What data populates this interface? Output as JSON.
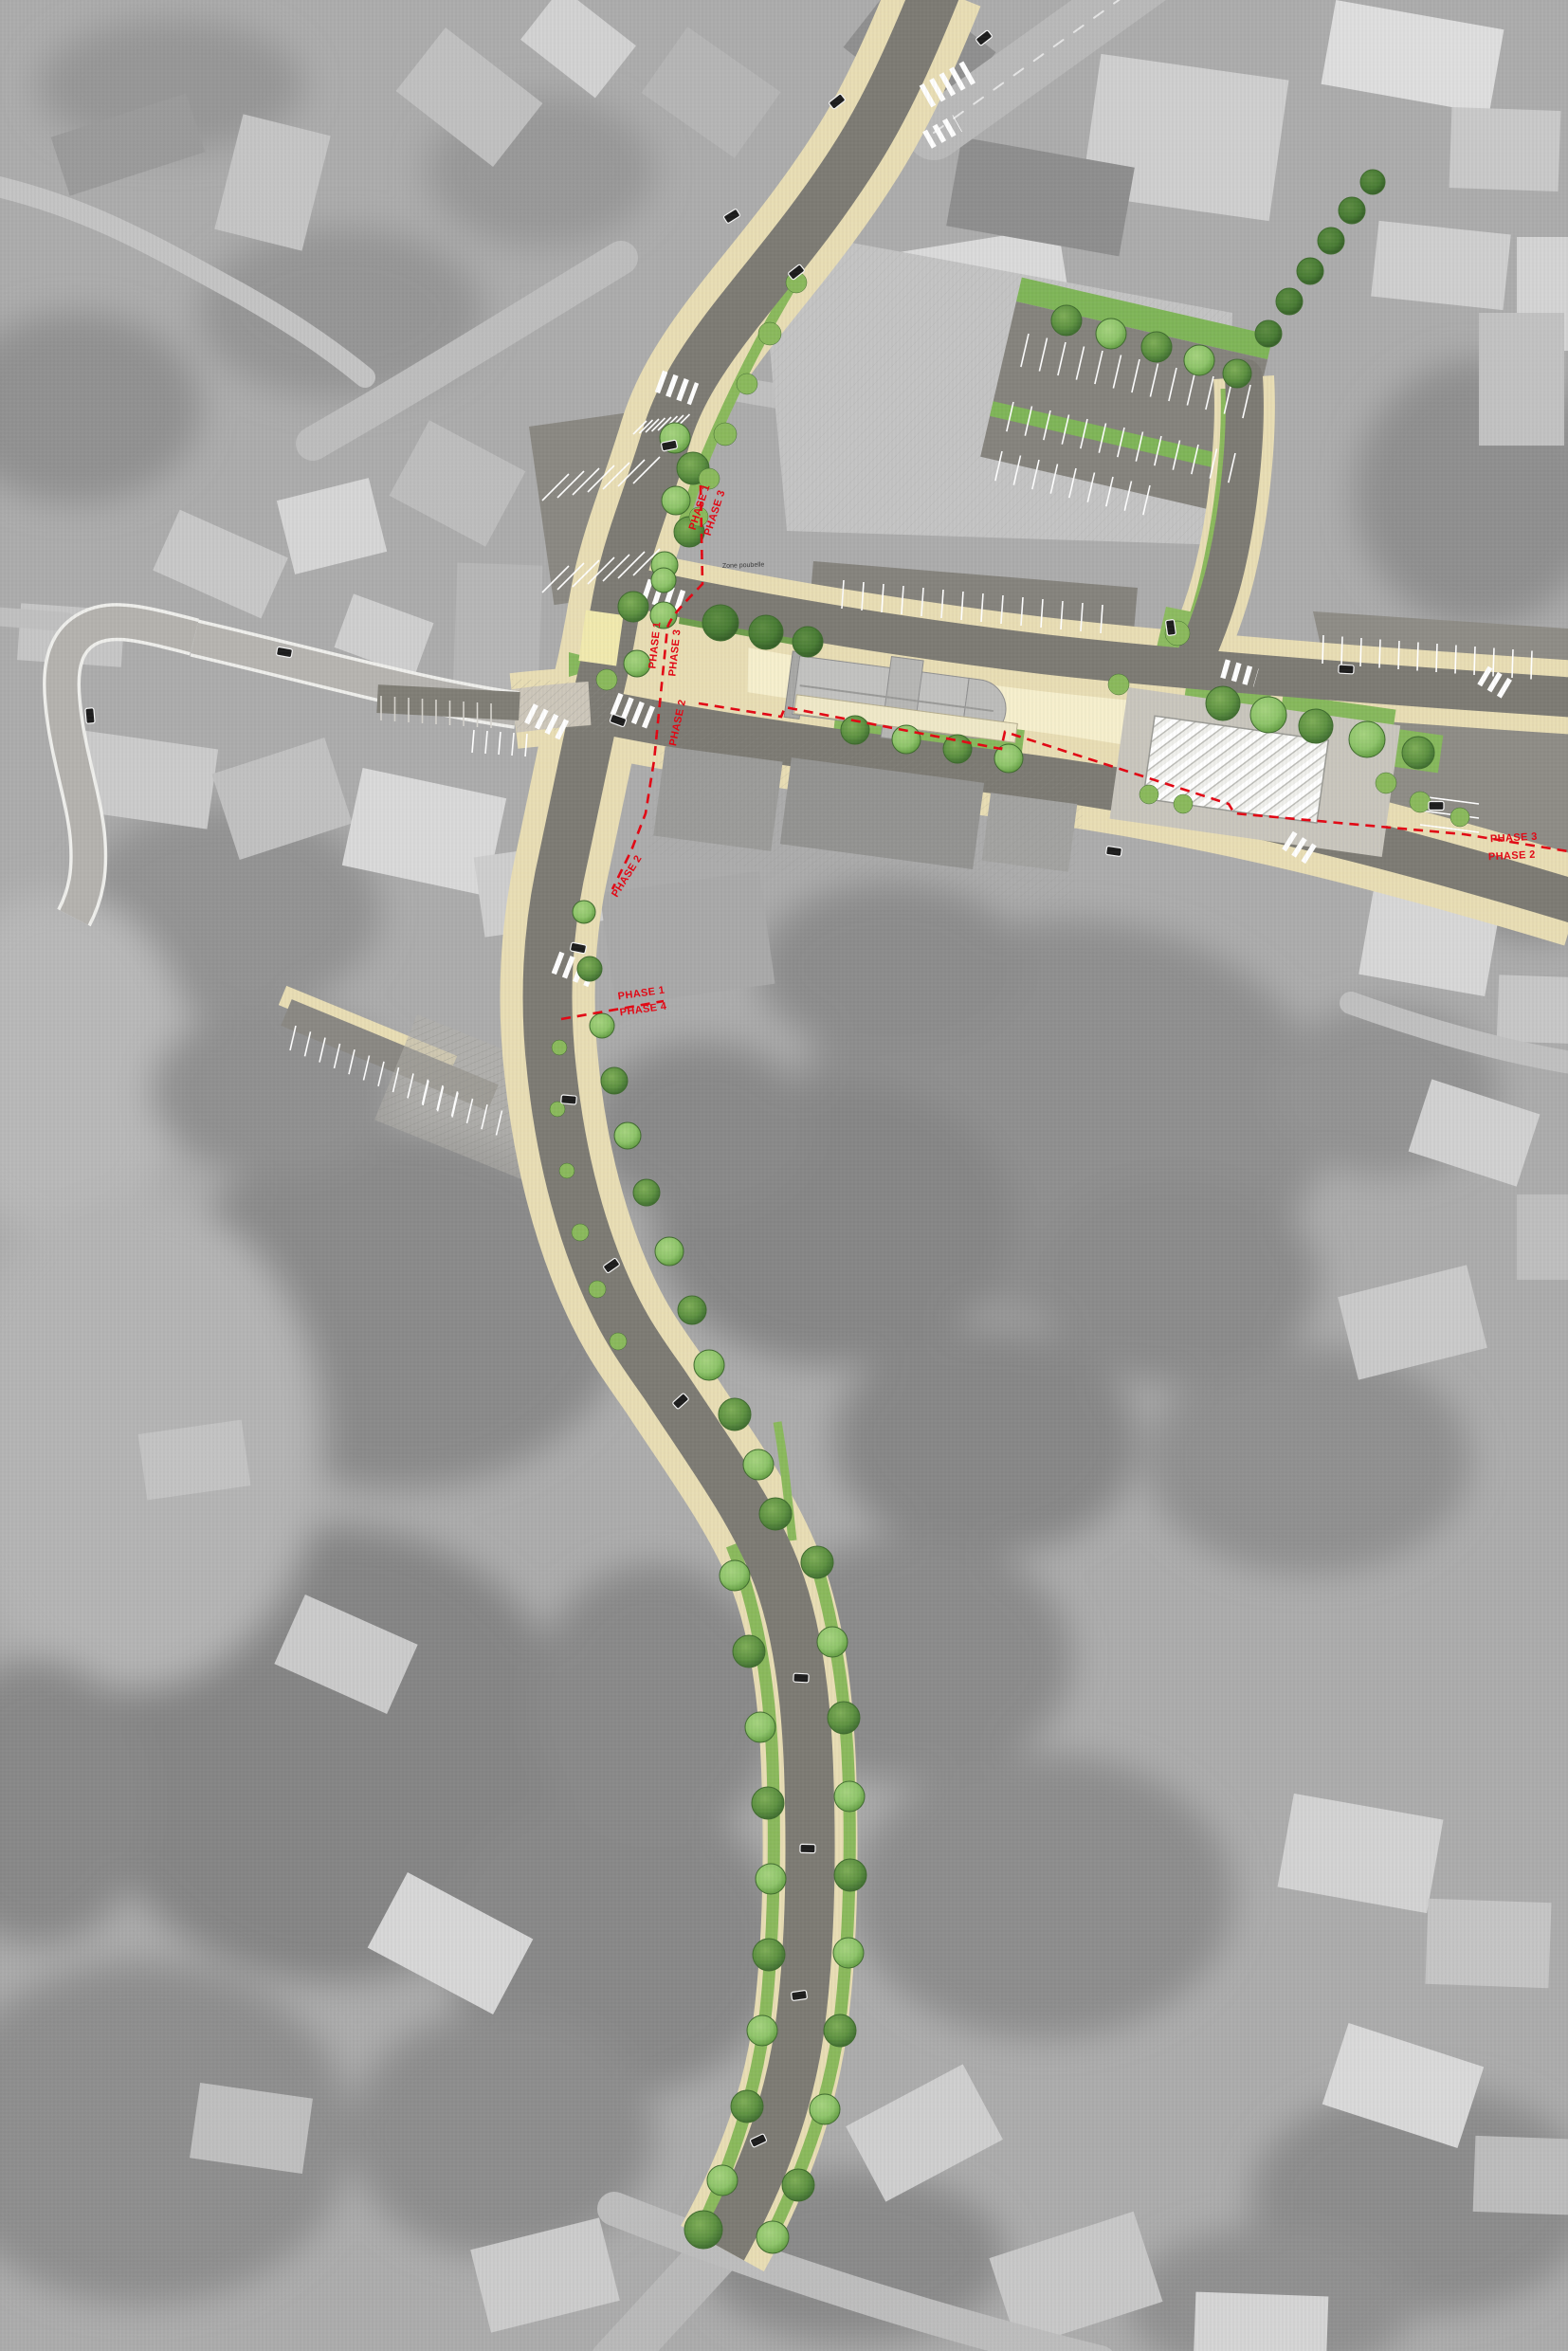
{
  "document": {
    "kind": "urban-redevelopment-phasing-plan",
    "base": "grayscale-aerial-photograph",
    "overlay": "colored-street-redesign"
  },
  "phase_labels": [
    {
      "id": "north-boundary-west-side",
      "text": "PHASE 1"
    },
    {
      "id": "north-boundary-east-side",
      "text": "PHASE 3"
    },
    {
      "id": "junction-boundary-west-side",
      "text": "PHASE 1"
    },
    {
      "id": "junction-boundary-east-side",
      "text": "PHASE 3"
    },
    {
      "id": "junction-south-segment",
      "text": "PHASE 2"
    },
    {
      "id": "southwest-diagonal-segment",
      "text": "PHASE 2"
    },
    {
      "id": "south-boundary-north-side",
      "text": "PHASE 1"
    },
    {
      "id": "south-boundary-south-side",
      "text": "PHASE 4"
    },
    {
      "id": "east-boundary-north-side",
      "text": "PHASE 3"
    },
    {
      "id": "east-boundary-south-side",
      "text": "PHASE 2"
    }
  ],
  "annotations": {
    "zone_poubelle": "Zone poubelle"
  },
  "colors": {
    "phase_red": "#e30613",
    "road": "#7d7b74",
    "road_existing": "#b6b4b0",
    "sidewalk": "#e8ddb4",
    "plaza_pale": "#f6efcd",
    "green_verge": "#8ab95c",
    "tree_light": "#8ec46a",
    "tree_dark": "#5d9141",
    "parking_surface": "#85837d",
    "photo_base": "#acacac",
    "marking_white": "#ffffff"
  }
}
